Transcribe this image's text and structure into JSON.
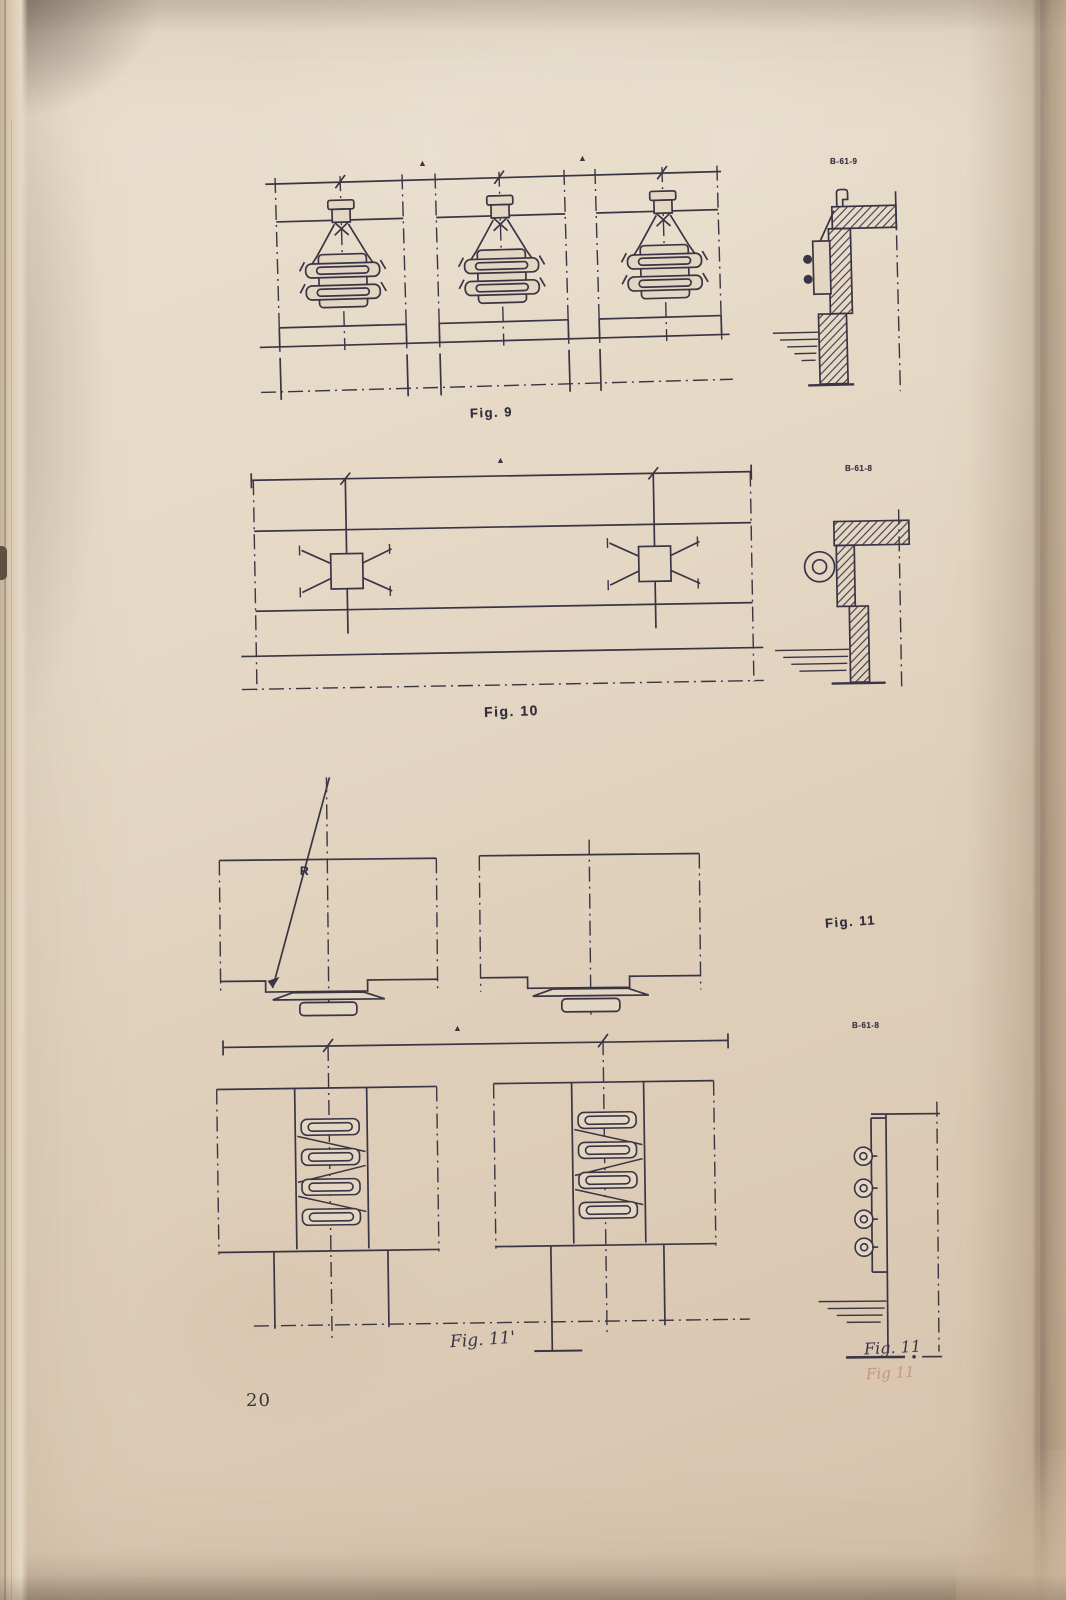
{
  "labels": {
    "fig9_caption": "Fig. 9",
    "fig9_ref": "B-61-9",
    "fig10_caption": "Fig. 10",
    "fig10_ref": "B-61-8",
    "fig11_caption": "Fig. 11",
    "fig11_ref": "B-61-8",
    "radius_label": "R",
    "delta_symbol": "▲",
    "fig11_prime_caption": "Fig. 11'",
    "fig11_section_caption": "Fig. 11",
    "fig11_section_caption_ghost": "Fig 11",
    "page_number": "20"
  },
  "colors": {
    "paper": "#e3d6c3",
    "ink": "#3a3545",
    "ghost_ink": "#ba6a5c"
  }
}
